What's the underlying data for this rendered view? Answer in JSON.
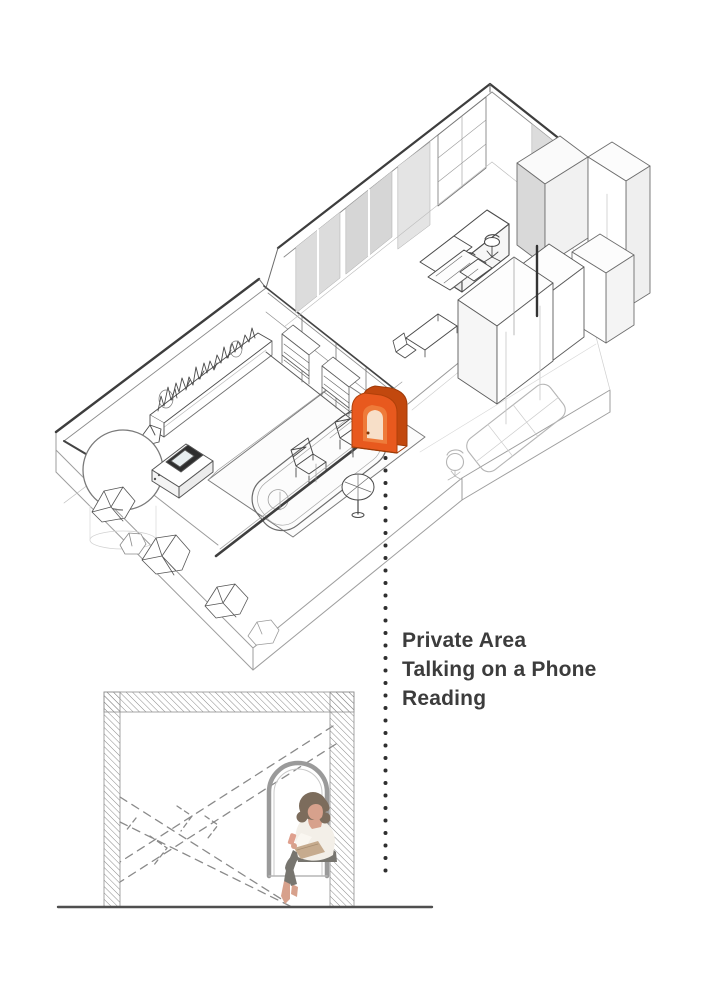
{
  "annotation": {
    "line1": "Private Area",
    "line2": "Talking on a Phone",
    "line3": "Reading"
  },
  "colors": {
    "highlight_orange": "#E8591E",
    "highlight_orange_dark": "#C2480E",
    "ink": "#3C3C3C",
    "drafting_line": "#555555",
    "ghost_line": "#B5B5B5"
  }
}
